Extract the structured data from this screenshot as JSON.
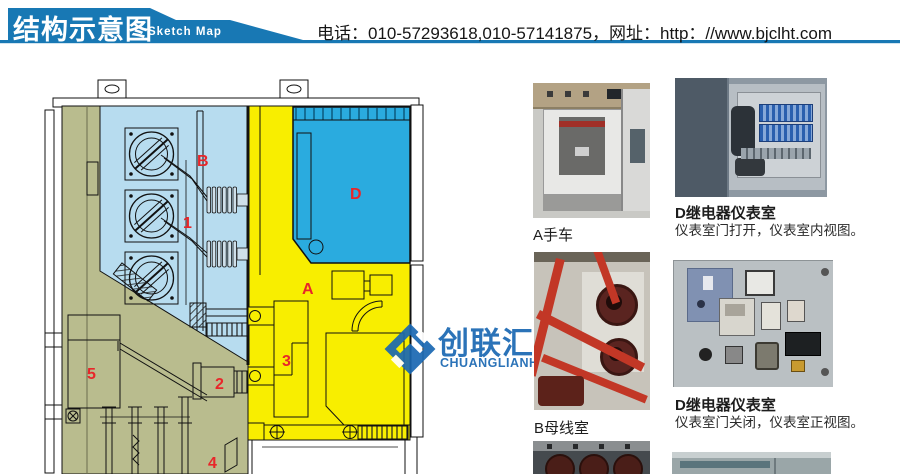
{
  "header": {
    "title_cn": "结构示意图",
    "title_en": "Sketch Map",
    "contact": "电话：010-57293618,010-57141875，网址：http：//www.bjclht.com"
  },
  "diagram": {
    "labels": [
      {
        "text": "B"
      },
      {
        "text": "1"
      },
      {
        "text": "D"
      },
      {
        "text": "A"
      },
      {
        "text": "3"
      },
      {
        "text": "2"
      },
      {
        "text": "5"
      },
      {
        "text": "4"
      }
    ]
  },
  "watermark": {
    "cn": "创联汇通",
    "en": "CHUANGLIANHUITONG"
  },
  "photos": {
    "a": {
      "caption": "A手车"
    },
    "b": {
      "caption": "B母线室"
    },
    "d1": {
      "title": "D继电器仪表室",
      "sub": "仪表室门打开，仪表室内视图。"
    },
    "d2": {
      "title": "D继电器仪表室",
      "sub": "仪表室门关闭，仪表室正视图。"
    }
  },
  "colors": {
    "header_blue": "#1878b4",
    "diagram_yellow": "#f8ee00",
    "diagram_light_blue": "#b7dcef",
    "diagram_cyan": "#2aabdf",
    "diagram_khaki": "#b9bc8e",
    "label_red": "#e8262a",
    "logo_blue": "#1a68b2"
  }
}
